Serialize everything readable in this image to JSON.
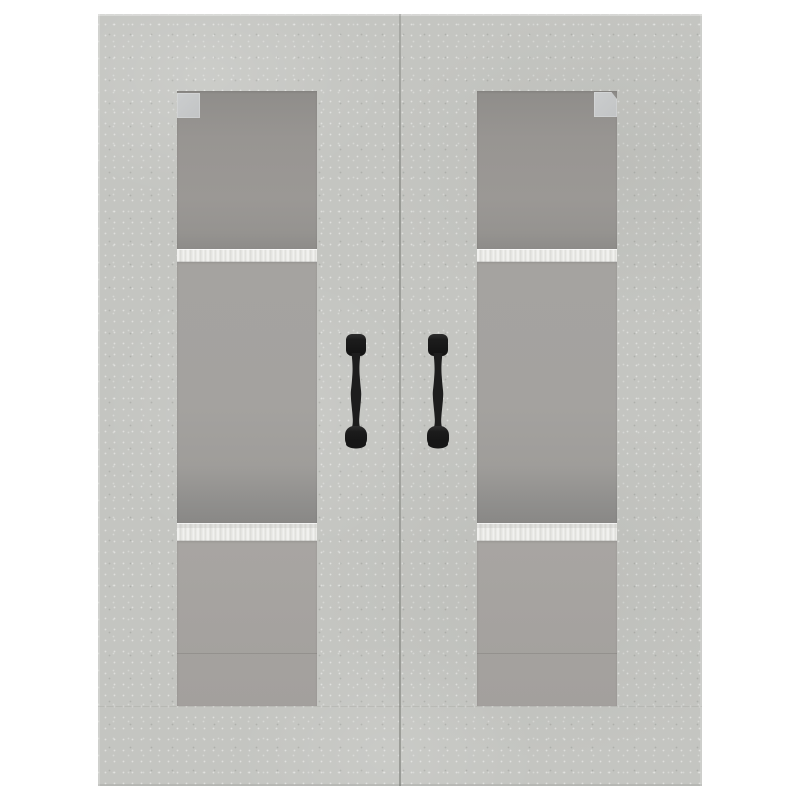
{
  "scene": {
    "type": "product-photograph",
    "subject": "wall-mounted hanging cabinet with two glass doors",
    "finish_description": "concrete-look grey",
    "doors_count": 2,
    "handles_count": 2,
    "shelves_per_door": 2,
    "compartments_per_door": 3,
    "hinge_plates_count": 2
  },
  "colors": {
    "background": "#ffffff",
    "frame_base": "#c4c5c1",
    "frame_speckle_light": "#d8d9d4",
    "frame_speckle_dark": "#b2b3af",
    "interior_dark": "#8f8d8a",
    "interior_mid": "#a5a3a0",
    "interior_light": "#a8a5a2",
    "interior_shadow": "#898886",
    "shelf_edge": "#ececea",
    "shelf_edge_stripe": "#dadad6",
    "hinge_plate": "#cbcdce",
    "handle": "#1b1b1b",
    "door_gap": "#6c6e68"
  }
}
